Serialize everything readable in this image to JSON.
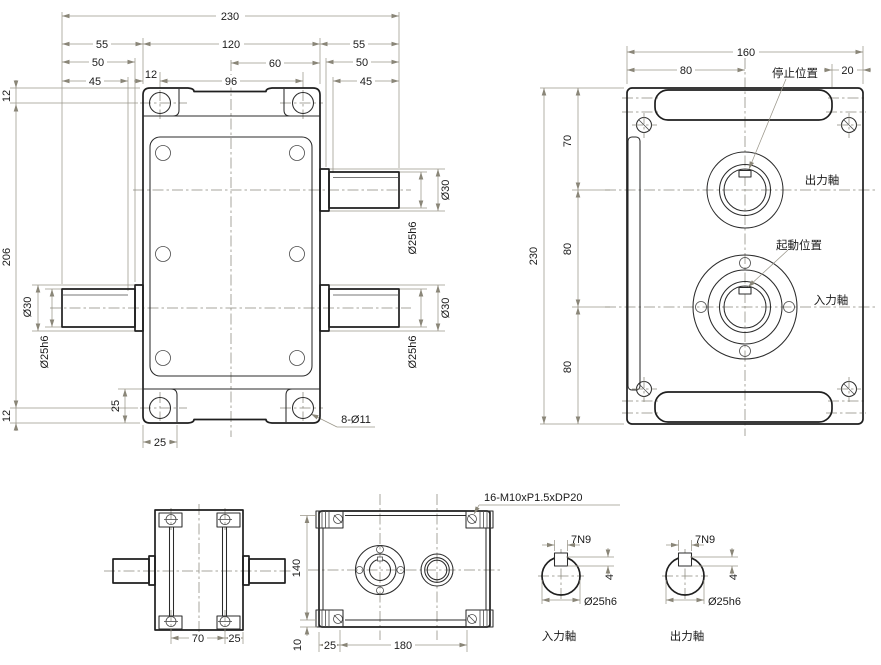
{
  "drawing": {
    "type": "mechanical engineering drawing, cam indexer / gearbox, 4 views + shaft sections",
    "background": "#ffffff",
    "line_color": "#1f1f1f",
    "dim_color": "#9a968a"
  },
  "front_view": {
    "d230": "230",
    "d55": "55",
    "d120": "120",
    "d50": "50",
    "d60": "60",
    "d45": "45",
    "d12": "12",
    "d96": "96",
    "d206": "206",
    "d25": "25",
    "dia30": "Ø30",
    "dia25": "Ø25h6",
    "holes_callout": "8-Ø11"
  },
  "side_view": {
    "d160": "160",
    "d80": "80",
    "d20": "20",
    "d230": "230",
    "d70": "70",
    "stop_position": "停止位置",
    "output_shaft": "出力軸",
    "start_position": "起動位置",
    "input_shaft": "入力軸"
  },
  "small_side_view": {
    "d70": "70",
    "d25": "25"
  },
  "bottom_view": {
    "d140": "140",
    "d10": "10",
    "d25": "25",
    "d180": "180",
    "tapped_holes_callout": "16-M10xP1.5xDP20"
  },
  "sections": {
    "key_width": "7N9",
    "key_depth": "4",
    "dia25": "Ø25h6",
    "input_shaft": "入力軸",
    "output_shaft": "出力軸"
  }
}
